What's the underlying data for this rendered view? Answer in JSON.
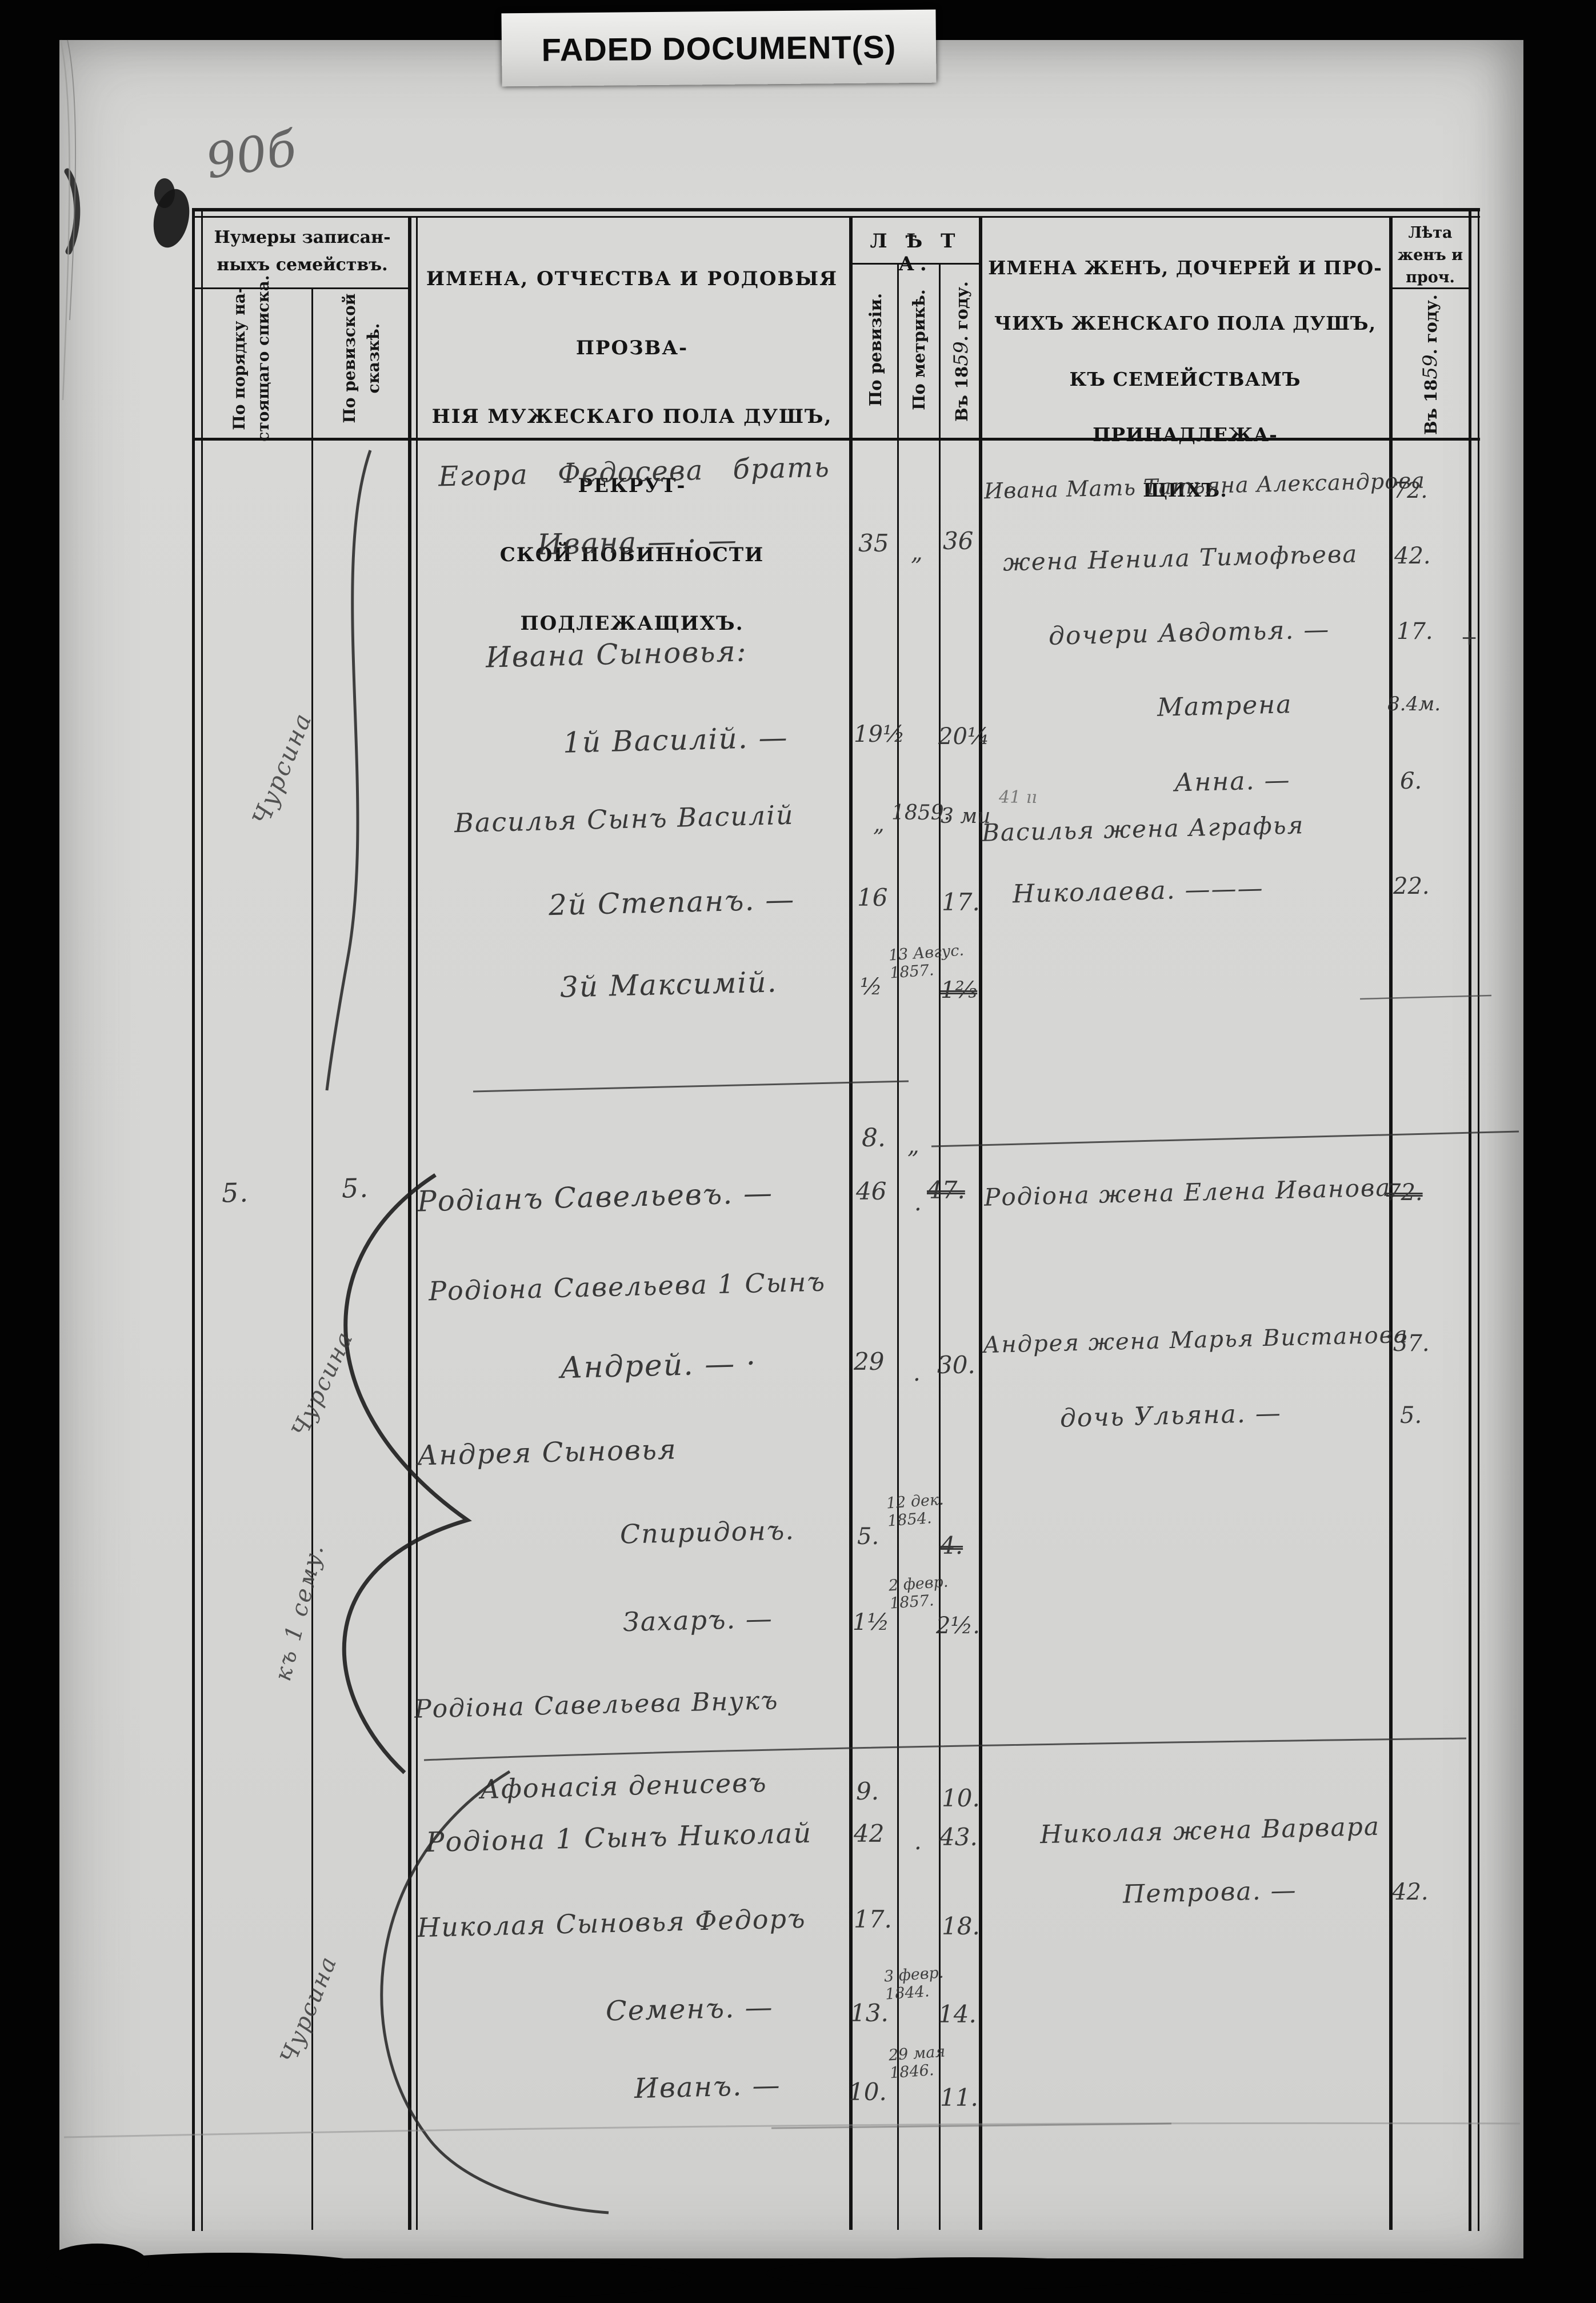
{
  "page": {
    "label": "FADED DOCUMENT(S)",
    "folio": "90б",
    "plus_mark": "+",
    "stray_mark": "41 ıı"
  },
  "header": {
    "family_numbers_title": "Нумеры записан-\nныхъ семействъ.",
    "col_order": "По порядку на-\nстоящаго списка.",
    "col_revision": "По ревизской\nсказкѣ.",
    "male_title": "ИМЕНА, ОТЧЕСТВА И РОДОВЫЯ ПРОЗВА-\nНІЯ МУЖЕСКАГО ПОЛА ДУШЪ, РЕКРУТ-\nСКОЙ ПОВИННОСТИ ПОДЛЕЖАЩИХЪ.",
    "leta_title": "Л Ѣ Т А.",
    "sub_revision": "По ревизіи.",
    "sub_metric": "По метрикѣ.",
    "sub_year_prefix": "Въ 18",
    "sub_year_hand": "59",
    "sub_year_suffix": ". году.",
    "female_title": "ИМЕНА ЖЕНЪ, ДОЧЕРЕЙ И ПРО-\nЧИХЪ ЖЕНСКАГО ПОЛА ДУШЪ,\nКЪ СЕМЕЙСТВАМЪ ПРИНАДЛЕЖА-\nЩИХЪ.",
    "female_age_title": "Лѣта\nженъ и\nпроч."
  },
  "families": {
    "order_no": "5.",
    "revision_no": "5."
  },
  "margin_notes": {
    "first": "Чурсина",
    "second": "Чурсина",
    "third": "къ 1 сему.",
    "fourth": "Чурсина"
  },
  "male": [
    {
      "name": "Егора Федосева брать"
    },
    {
      "name": "Ивана — · —",
      "rev": "35",
      "metr": "„",
      "y1859": "36"
    },
    {
      "name": "Ивана Сыновья:"
    },
    {
      "name": "1й Василій. —",
      "rev": "19½",
      "y1859": "20¼"
    },
    {
      "name": "Василья Сынъ Василій",
      "rev": "„",
      "metr": "1859.",
      "y1859": "3 ми"
    },
    {
      "name": "2й Степанъ. —",
      "rev": "16",
      "y1859": "17."
    },
    {
      "name": "3й Максимій.",
      "rev": "½",
      "metr": "13 Авгус.\n1857.",
      "y1859": "1⅔"
    },
    {
      "name": "",
      "rev": "8.",
      "metr": "„"
    },
    {
      "name": "Родіанъ Савельевъ. —",
      "rev": "46",
      "metr": ".",
      "y1859": "47."
    },
    {
      "name": "Родіона Савельева 1 Сынъ"
    },
    {
      "name": "Андрей. — ·",
      "rev": "29",
      "metr": ".",
      "y1859": "30."
    },
    {
      "name": "Андрея Сыновья"
    },
    {
      "name": "Спиридонъ.",
      "rev": "5.",
      "metr": "12 дек.\n1854.",
      "y1859": "4."
    },
    {
      "name": "Захаръ. —",
      "rev": "1½",
      "metr": "2 февр.\n1857.",
      "y1859": "2½."
    },
    {
      "name": "Родіона Савельева Внукъ"
    },
    {
      "name": "Афонасія денисевъ",
      "rev": "9.",
      "y1859": "10."
    },
    {
      "name": "Родіона 1 Сынъ Николай",
      "rev": "42",
      "metr": ".",
      "y1859": "43."
    },
    {
      "name": "Николая Сыновья Федоръ",
      "rev": "17.",
      "y1859": "18."
    },
    {
      "name": "Семенъ. —",
      "rev": "13.",
      "metr": "3 февр.\n1844.",
      "y1859": "14."
    },
    {
      "name": "Иванъ. —",
      "rev": "10.",
      "metr": "29 мая\n1846.",
      "y1859": "11."
    }
  ],
  "female": [
    {
      "name": "Ивана Мать Татьяна Александрова",
      "age": "72."
    },
    {
      "name": "жена Ненила Тимофѣева",
      "age": "42."
    },
    {
      "name": "дочери Авдотья. —",
      "age": "17."
    },
    {
      "name": "Матрена",
      "age": "8.4м."
    },
    {
      "name": "Анна. —",
      "age": "6."
    },
    {
      "name": "Василья жена Аграфья"
    },
    {
      "name": "Николаева. ———",
      "age": "22."
    },
    {
      "name": "Родіона жена Елена Иванова",
      "age": "72."
    },
    {
      "name": "Андрея жена Марья Вистанова",
      "age": "37."
    },
    {
      "name": "дочь Ульяна. —",
      "age": "5."
    },
    {
      "name": "Николая жена Варвара"
    },
    {
      "name": "Петрова. —",
      "age": "42."
    }
  ]
}
